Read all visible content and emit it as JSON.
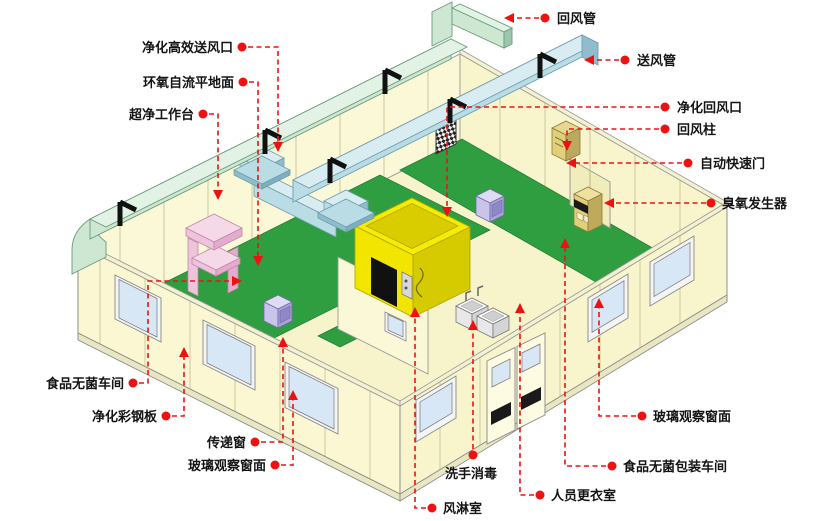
{
  "diagram": {
    "type": "isometric-cutaway-cleanroom-schematic",
    "labels": {
      "hepa_supply_vent": "净化高效送风口",
      "epoxy_floor": "环氧自流平地面",
      "clean_workbench": "超净工作台",
      "sterile_workshop": "食品无菌车间",
      "color_steel_panel": "净化彩钢板",
      "transfer_window": "传递窗",
      "glass_window_left": "玻璃观察窗面",
      "return_duct": "回风管",
      "supply_duct": "送风管",
      "purify_return_vent": "净化回风口",
      "return_column": "回风柱",
      "auto_quick_door": "自动快速门",
      "ozone_generator": "臭氧发生器",
      "glass_window_right": "玻璃观察窗面",
      "packing_workshop": "食品无菌包装车间",
      "changing_room": "人员更衣室",
      "air_shower": "风淋室",
      "hand_wash": "洗手消毒"
    }
  },
  "colors": {
    "leader_red": "#ee1111",
    "floor_green": "#2f9e41",
    "floor_cream": "#f7f4cb",
    "wall_cream": "#fbf8d8",
    "wall_cream2": "#f8f5cd",
    "wall_cream3": "#faf7d2",
    "duct_green": "#cde7d2",
    "duct_blue": "#b9dce5",
    "airshower_yellow": "#f2e600",
    "bench_pink": "#f6d9e8",
    "equip_lavender": "#c9c5ea",
    "window_blue": "#d7e7f6",
    "ozone_tan": "#e0d07c"
  }
}
